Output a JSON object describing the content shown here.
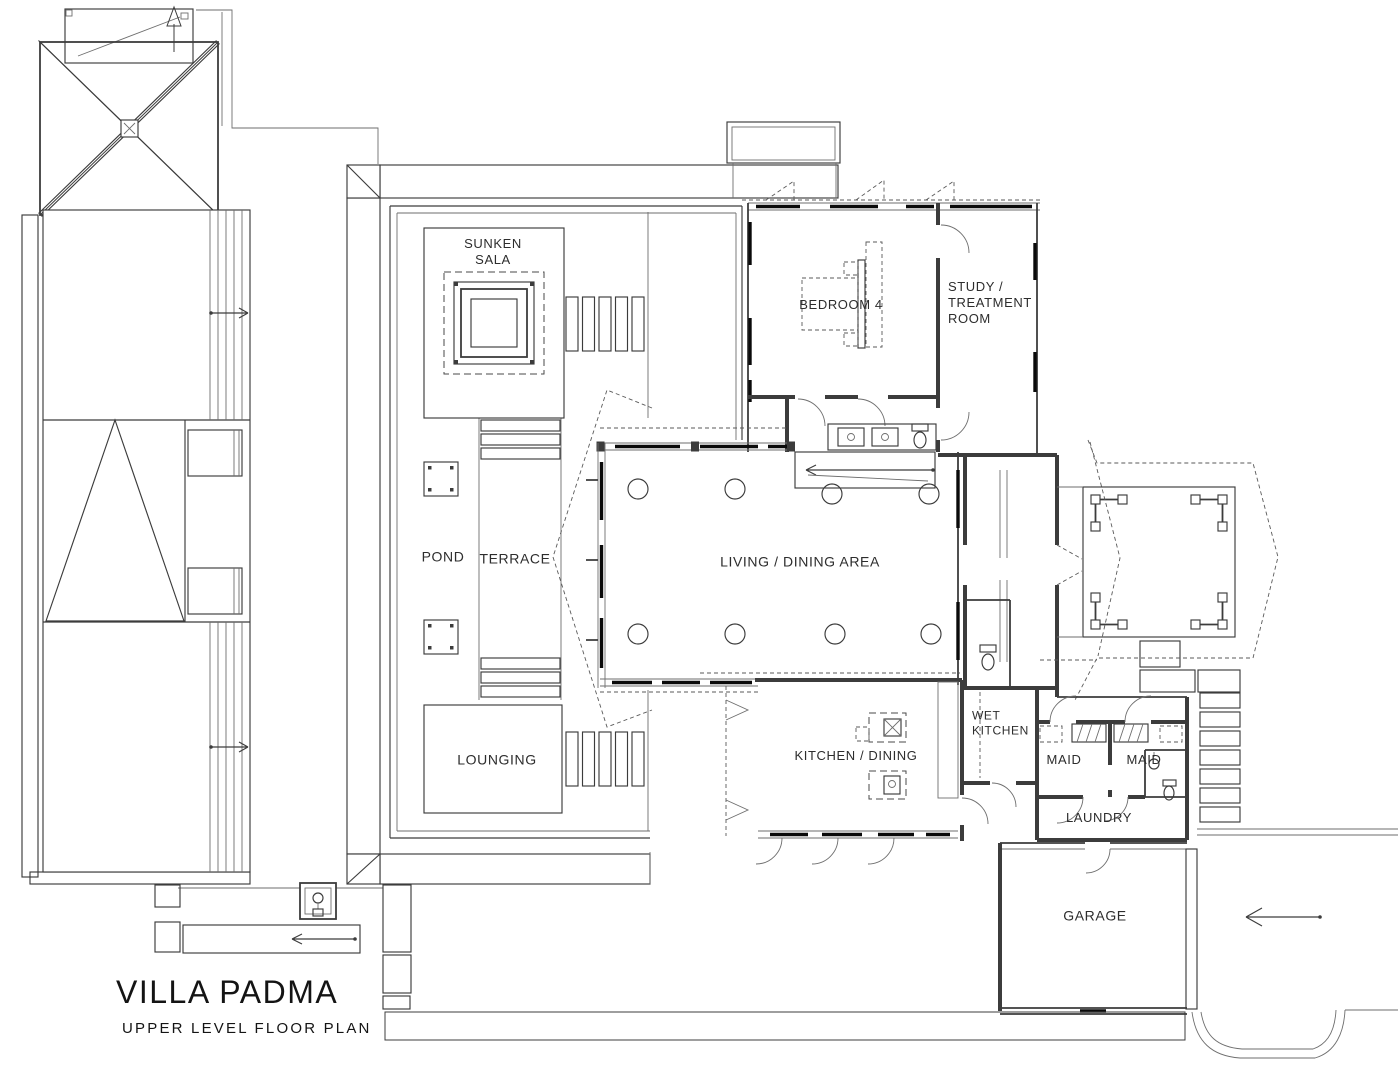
{
  "title_block": {
    "title": "VILLA PADMA",
    "subtitle": "UPPER LEVEL FLOOR PLAN"
  },
  "colors": {
    "ink": "#3c3c3c",
    "paper": "#ffffff",
    "black_glazing": "#0a0a0a"
  },
  "labels": [
    {
      "id": "sunken-sala",
      "lines": [
        "SUNKEN",
        "SALA"
      ],
      "x": 493,
      "y": 252,
      "fs": 13,
      "align": "center"
    },
    {
      "id": "bedroom-4",
      "lines": [
        "BEDROOM 4"
      ],
      "x": 841,
      "y": 305,
      "fs": 13,
      "align": "center"
    },
    {
      "id": "study-treatment-room",
      "lines": [
        "STUDY /",
        "TREATMENT",
        "ROOM"
      ],
      "x": 948,
      "y": 303,
      "fs": 13,
      "align": "left"
    },
    {
      "id": "living-dining-area",
      "lines": [
        "LIVING / DINING AREA"
      ],
      "x": 800,
      "y": 562,
      "fs": 14,
      "align": "center"
    },
    {
      "id": "pond",
      "lines": [
        "POND"
      ],
      "x": 443,
      "y": 557,
      "fs": 14,
      "align": "center"
    },
    {
      "id": "terrace",
      "lines": [
        "TERRACE"
      ],
      "x": 515,
      "y": 559,
      "fs": 14,
      "align": "center"
    },
    {
      "id": "lounging",
      "lines": [
        "LOUNGING"
      ],
      "x": 497,
      "y": 760,
      "fs": 14,
      "align": "center"
    },
    {
      "id": "kitchen-dining",
      "lines": [
        "KITCHEN / DINING"
      ],
      "x": 856,
      "y": 756,
      "fs": 13,
      "align": "center"
    },
    {
      "id": "wet-kitchen",
      "lines": [
        "WET",
        "KITCHEN"
      ],
      "x": 972,
      "y": 723,
      "fs": 12,
      "align": "left"
    },
    {
      "id": "maid-1",
      "lines": [
        "MAID"
      ],
      "x": 1064,
      "y": 760,
      "fs": 13,
      "align": "center"
    },
    {
      "id": "maid-2",
      "lines": [
        "MAID"
      ],
      "x": 1144,
      "y": 760,
      "fs": 13,
      "align": "center"
    },
    {
      "id": "laundry",
      "lines": [
        "LAUNDRY"
      ],
      "x": 1099,
      "y": 818,
      "fs": 13,
      "align": "center"
    },
    {
      "id": "garage",
      "lines": [
        "GARAGE"
      ],
      "x": 1095,
      "y": 916,
      "fs": 14,
      "align": "center"
    }
  ]
}
